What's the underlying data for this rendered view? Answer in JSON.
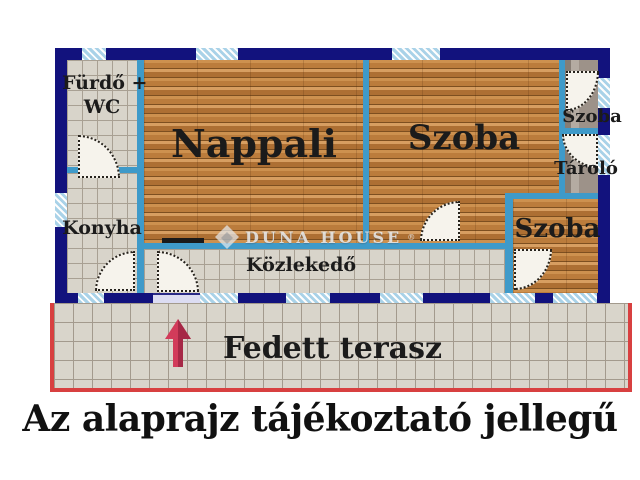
{
  "title": {
    "caption": "Az alaprajz tájékoztató jellegű"
  },
  "watermark": {
    "text": "DUNA HOUSE",
    "registered": "®"
  },
  "rooms": {
    "furdo": {
      "line1": "Fürdő +",
      "line2": "WC"
    },
    "konyha": {
      "label": "Konyha"
    },
    "nappali": {
      "label": "Nappali"
    },
    "szoba_nagy": {
      "label": "Szoba"
    },
    "szoba_kis": {
      "label": "Szoba"
    },
    "tarolo": {
      "label": "Tároló"
    },
    "szoba_also": {
      "label": "Szoba"
    },
    "kozlekedo": {
      "label": "Közlekedő"
    },
    "terasz": {
      "label": "Fedett terasz"
    }
  },
  "icons": {
    "entrance_arrow": "up-arrow",
    "watermark_logo": "duna-house-diamond",
    "doors": "quarter-circle-door-swing"
  },
  "colors": {
    "outer-wall": "#12127d",
    "inner-wall": "#3f9ac9",
    "window-blue": "#a9d2e8",
    "tile-floor": "#d8d4ca",
    "tile-line": "#a8a093",
    "wood-mid": "#bc7f40",
    "carpet": "#9d9289",
    "door-fill": "#f6f3ec",
    "terrace-border": "#d84040",
    "arrow-red": "#d23b5a",
    "arrow-red-dark": "#a62846"
  }
}
